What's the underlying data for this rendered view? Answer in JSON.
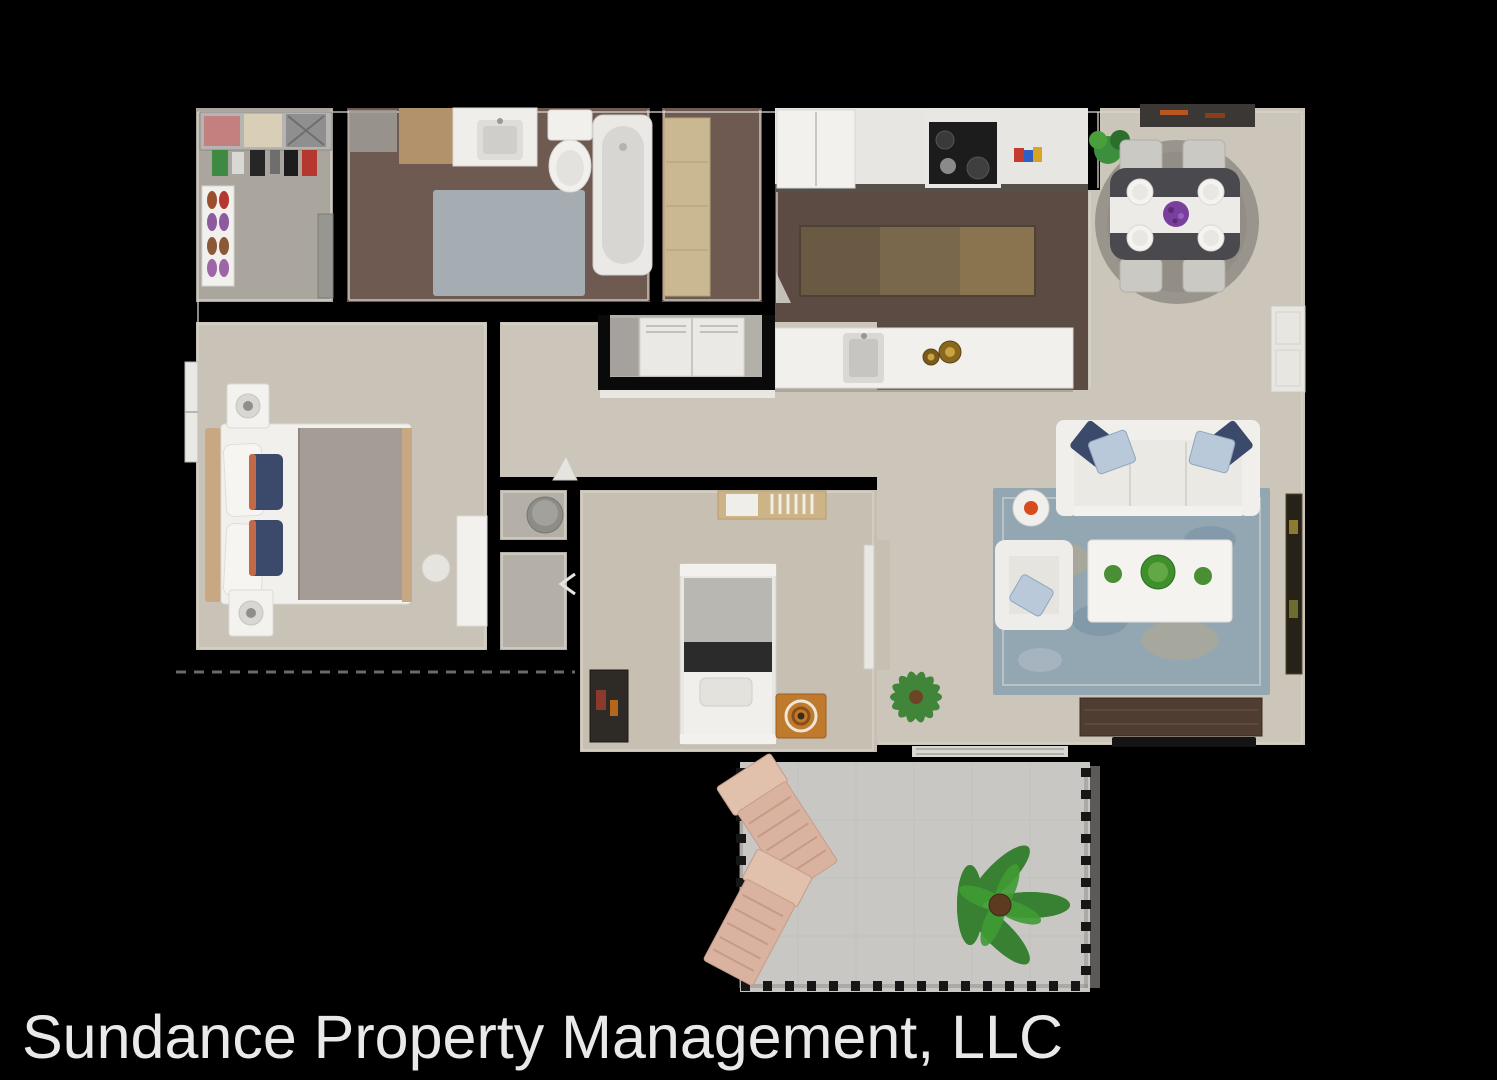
{
  "footer": {
    "text": "Sundance Property Management, LLC"
  },
  "colors": {
    "background": "#000000",
    "footer_text": "#e9e9e9",
    "carpet": "#ccc5b9",
    "carpet_master": "#c9c2b6",
    "carpet_bedroom2": "#c6bfb2",
    "carpet_closet": "#aba69d",
    "wood_bath": "#6e5a50",
    "wood_kitchen": "#5c4b42",
    "concrete_patio": "#c8c7c3",
    "white_furniture": "#f1f0ec",
    "rug_living_blue": "#93a7b3",
    "rug_dining_gray": "#99948c",
    "rug_bath_blue": "#a9b2b7",
    "rug_kitchen_brown": "#7a684c",
    "dining_table_dark": "#49494e",
    "tv_console_wood": "#4e3d30",
    "plant_green": "#2e7d2a",
    "accent_orange": "#d84b1e",
    "pillow_navy": "#3b4a6a",
    "pillow_light_blue": "#b9c9da",
    "tan_cabinet": "#c9b891",
    "patio_chair_wood": "#d9b3a0"
  },
  "plan": {
    "type": "3d-floor-plan-top-view",
    "rooms": [
      {
        "name": "walk-in-closet",
        "furniture": [
          "clothes-shelf",
          "folded-clothes",
          "hanging-clothes",
          "shoe-rack",
          "dresser"
        ]
      },
      {
        "name": "bathroom",
        "furniture": [
          "vanity-cabinet",
          "sink-counter",
          "toilet",
          "bathtub",
          "bath-rug"
        ]
      },
      {
        "name": "linen-closet",
        "furniture": [
          "tan-cabinet"
        ]
      },
      {
        "name": "kitchen",
        "furniture": [
          "refrigerator",
          "counter",
          "stove",
          "counter-items",
          "runner-rug",
          "island-with-sink",
          "bowls"
        ]
      },
      {
        "name": "dining-area",
        "furniture": [
          "doormat",
          "corner-plant",
          "round-rug",
          "dining-table",
          "table-runner",
          "place-settings",
          "centerpiece",
          "four-chairs"
        ]
      },
      {
        "name": "living-room",
        "furniture": [
          "sofa",
          "throw-pillows",
          "side-table-with-bowl",
          "armchair",
          "coffee-table-with-plants",
          "area-rug",
          "tv-console",
          "tv",
          "wall-art",
          "interior-door",
          "entry-threshold",
          "floor-plant"
        ]
      },
      {
        "name": "master-bedroom",
        "furniture": [
          "queen-bed",
          "pillows",
          "nightstand-with-lamp",
          "nightstand-with-lamp",
          "desk",
          "stool",
          "window"
        ]
      },
      {
        "name": "second-bedroom",
        "furniture": [
          "twin-bed",
          "wall-shelf",
          "bookshelf",
          "toy-box",
          "door-panel"
        ]
      },
      {
        "name": "hallway",
        "furniture": [
          "laundry-closet",
          "stacked-laundry-units",
          "door-swing"
        ]
      },
      {
        "name": "hall-closets",
        "furniture": [
          "laundry-basket"
        ]
      },
      {
        "name": "patio",
        "furniture": [
          "lounge-chair",
          "lounge-chair",
          "palm-plant",
          "railing"
        ]
      }
    ]
  }
}
